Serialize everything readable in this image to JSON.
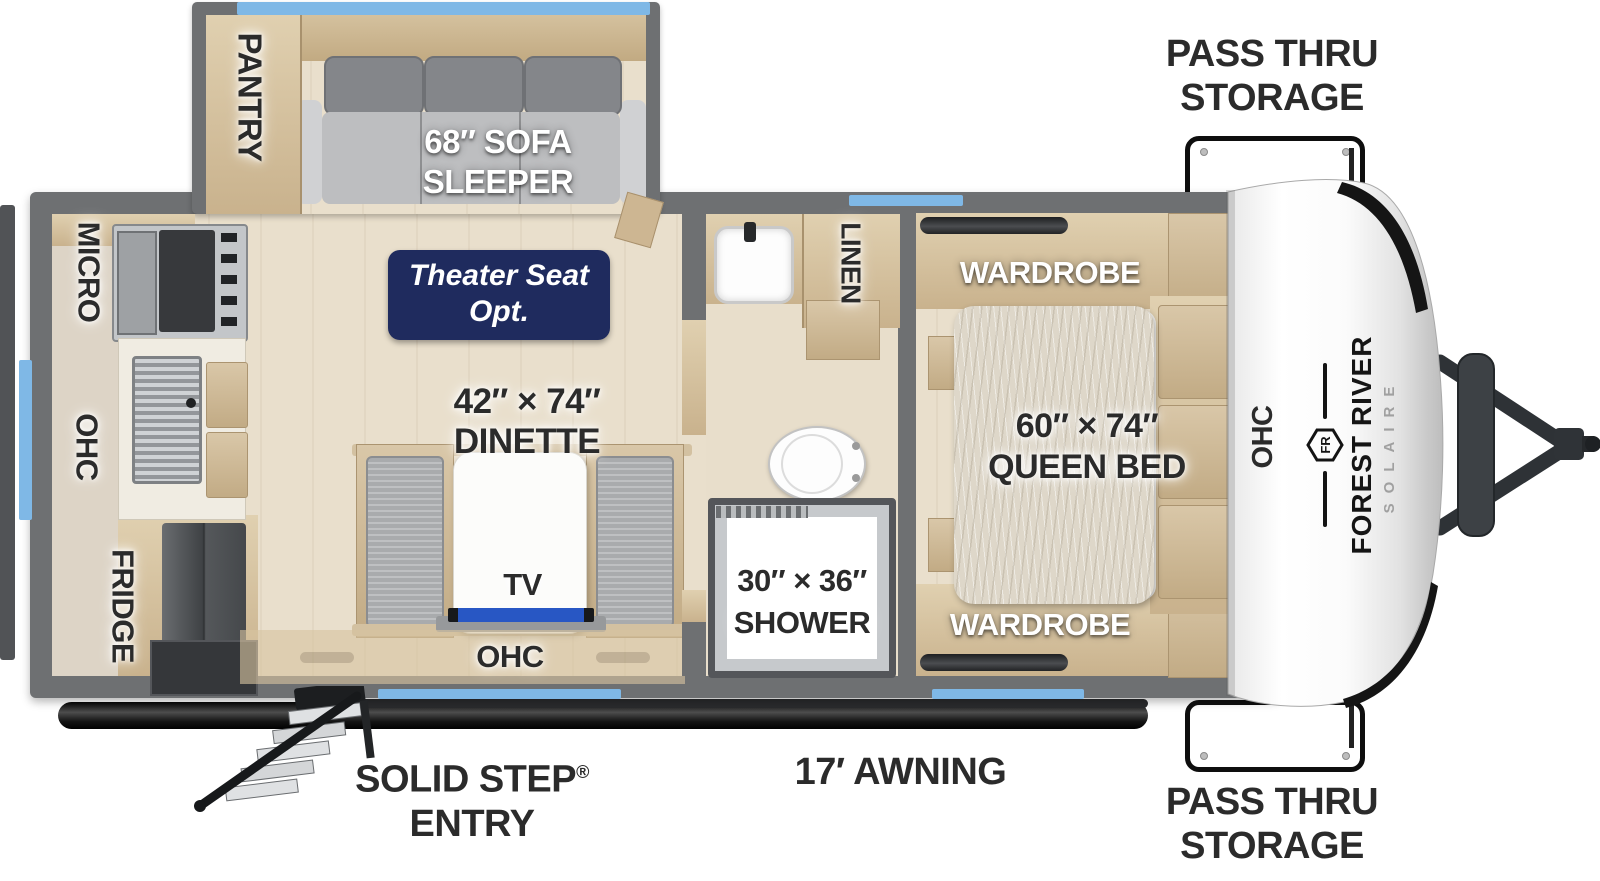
{
  "exterior": {
    "pass_thru_top": {
      "line1": "PASS THRU",
      "line2": "STORAGE"
    },
    "pass_thru_bottom": {
      "line1": "PASS THRU",
      "line2": "STORAGE"
    },
    "solid_step": {
      "line1": "SOLID STEP",
      "reg": "®",
      "line2": "ENTRY"
    },
    "awning": "17′ AWNING"
  },
  "living": {
    "pantry": "PANTRY",
    "sofa_line1": "68″ SOFA",
    "sofa_line2": "SLEEPER",
    "theater_line1": "Theater Seat",
    "theater_line2": "Opt.",
    "dinette_line1": "42″ × 74″",
    "dinette_line2": "DINETTE",
    "tv": "TV",
    "ohc": "OHC"
  },
  "kitchen": {
    "micro": "MICRO",
    "ohc": "OHC",
    "fridge": "FRIDGE"
  },
  "bathroom": {
    "linen": "LINEN",
    "shower_line1": "30″ × 36″",
    "shower_line2": "SHOWER"
  },
  "bedroom": {
    "wardrobe_top": "WARDROBE",
    "wardrobe_bottom": "WARDROBE",
    "bed_line1": "60″ × 74″",
    "bed_line2": "QUEEN BED",
    "ohc": "OHC"
  },
  "brand": {
    "name": "FOREST RIVER",
    "model": "SOLAIRE",
    "logo": "FR"
  },
  "colors": {
    "badge_navy": "#1f2b5e",
    "window_blue": "#7fb8e6",
    "tv_blue": "#2857c4",
    "wall_gray": "#6e7072",
    "wood_tan": "#d8c6a6",
    "label_dark": "#2b2b2b"
  }
}
